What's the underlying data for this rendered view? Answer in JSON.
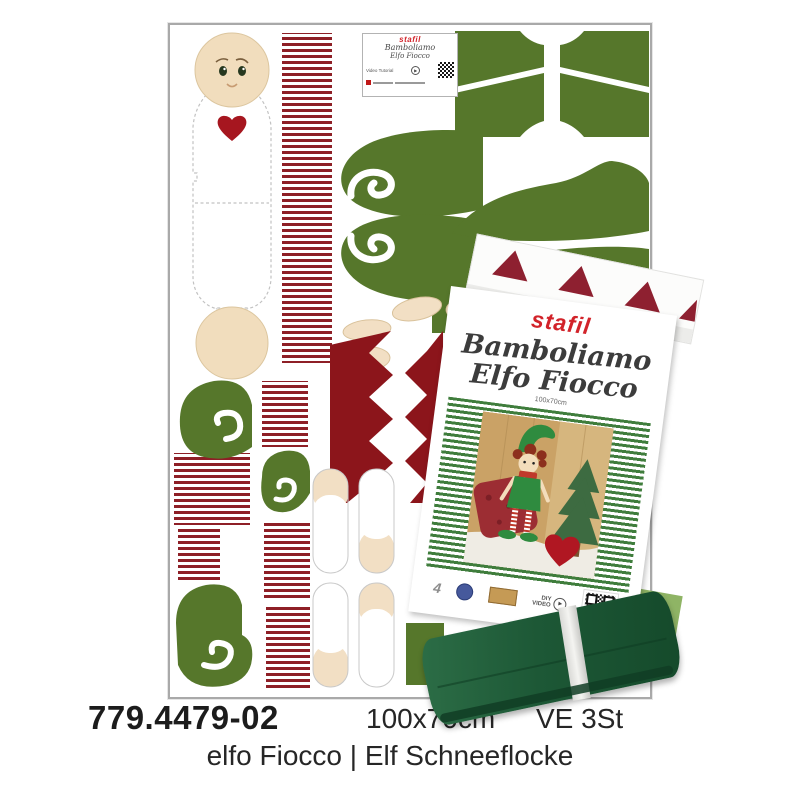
{
  "title_block": {
    "sku": "779.4479-02",
    "size": "100x70cm",
    "unit": "VE 3St",
    "name": "elfo Fiocco | Elf Schneeflocke"
  },
  "panel_label": {
    "brand": "stafil",
    "title_line1": "Bamboliamo",
    "title_line2": "Elfo Fiocco",
    "video_tutorial": "Video Tutorial"
  },
  "package_label": {
    "brand": "stafil",
    "title_line1": "Bamboliamo",
    "title_line2": "Elfo Fiocco",
    "size": "100x70cm",
    "quantity": "4",
    "diy_line1": "DIY",
    "diy_line2": "VIDEO"
  },
  "icons": {
    "play": "▶"
  },
  "colors": {
    "brand_red": "#d2232a",
    "stripe_red": "#8e1f26",
    "leaf_green": "#56772b",
    "maroon_collar": "#8c151b",
    "bow_red": "#a5161c",
    "cream": "#f2dfc4",
    "dark_green_fabric": "#1d5836"
  }
}
